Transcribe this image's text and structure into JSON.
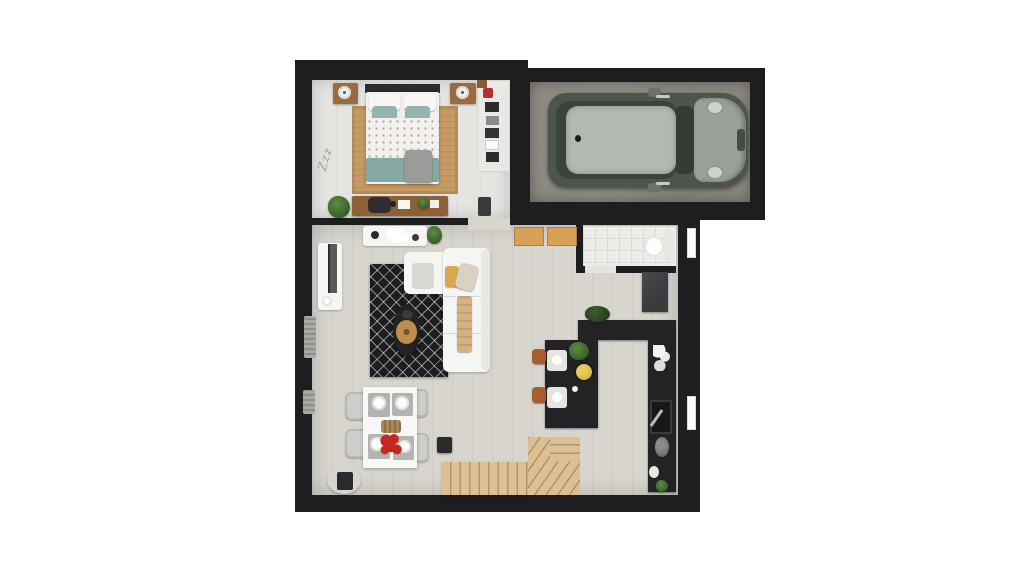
{
  "title": "3D floor plan - top-down architectural rendering",
  "palette": {
    "wall": "#1e1e20",
    "floor_bedroom": "#e5e4e1",
    "floor_living": "#d8d5cf",
    "floor_garage": "#8e8a83",
    "floor_bath": "#edece8",
    "tile_line": "#dbdad6",
    "rug_jute": "#c59a63",
    "rug_black": "#1d1d1f",
    "counter": "#232325",
    "stairs": "#dcc094",
    "stairs_line": "#b3946a",
    "cube_tan": "#d8a157",
    "stool": "#a75d2e",
    "sofa": "#f5f5f3",
    "teal": "#85a8a3",
    "duvet": "#f2f1ee",
    "wood": "#9a6a40",
    "desk_wood": "#8d6038",
    "car_body": "#4d544d",
    "car_roof": "#b2b8b2",
    "car_hood": "#99a199",
    "chair_gray": "#cdcdcb",
    "table_white": "#f7f7f5",
    "red": "#c6261f",
    "lemon": "#d8b63c",
    "plant": "#355c28",
    "gray_blanket": "#9b9b99",
    "fridge": "#3b3b3d"
  },
  "bedroom": {
    "floor_text": "Zzz",
    "objects": [
      "double-bed with white dotted duvet and teal pillows",
      "jute rug",
      "left nightstand with lamp",
      "right nightstand with lamp",
      "open wardrobe shelves with clothes",
      "wooden desk with chair",
      "potted plant",
      "gray folded blanket"
    ]
  },
  "garage": {
    "objects": [
      "compact car, olive-gray body, light gray roof, parked facing right"
    ]
  },
  "living_room": {
    "objects": [
      "white L-shaped sofa with tan throws",
      "black berber rug",
      "oval black coffee table with round jute tray",
      "white TV console with TV",
      "white console table with tableware",
      "potted plant",
      "two wall radiators",
      "black side cube",
      "round side table with lamp"
    ]
  },
  "dining": {
    "objects": [
      "white dining table",
      "four gray chairs",
      "place settings with white plates",
      "bread basket",
      "red flower centerpiece"
    ]
  },
  "kitchen": {
    "objects": [
      "black U-shaped counter",
      "breakfast island with two white plates",
      "two brown bar stools",
      "bowl of lemons",
      "herb plants",
      "sink with faucet",
      "dark refrigerator",
      "round pot",
      "small plant"
    ]
  },
  "bathroom": {
    "objects": [
      "white tiled floor",
      "toilet"
    ]
  },
  "hall": {
    "objects": [
      "two tan storage cubes",
      "L-shaped wooden staircase"
    ]
  }
}
